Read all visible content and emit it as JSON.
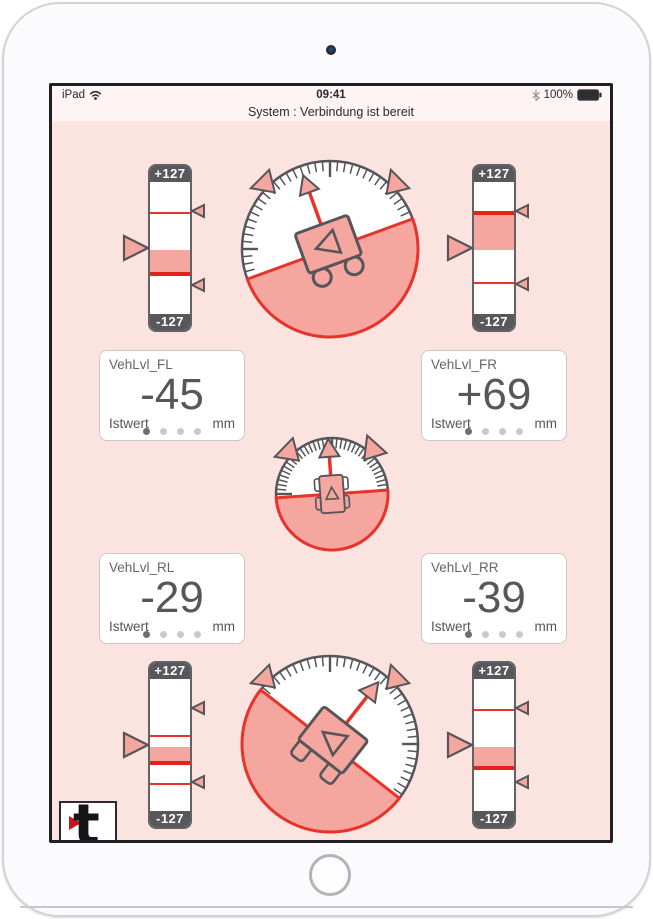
{
  "status_bar": {
    "carrier": "iPad",
    "time": "09:41",
    "battery_pct": "100%"
  },
  "subtitle": "System : Verbindung ist bereit",
  "cards": [
    {
      "title": "VehLvl_FL",
      "value": "-45",
      "caption_left": "Istwert",
      "caption_right": "mm",
      "dots": [
        true,
        false,
        false,
        false
      ]
    },
    {
      "title": "VehLvl_FR",
      "value": "+69",
      "caption_left": "Istwert",
      "caption_right": "mm",
      "dots": [
        true,
        false,
        false,
        false
      ]
    },
    {
      "title": "VehLvl_RL",
      "value": "-29",
      "caption_left": "Istwert",
      "caption_right": "mm",
      "dots": [
        true,
        false,
        false,
        false
      ]
    },
    {
      "title": "VehLvl_RR",
      "value": "-39",
      "caption_left": "Istwert",
      "caption_right": "mm",
      "dots": [
        true,
        false,
        false,
        false
      ]
    }
  ],
  "vgauges": [
    {
      "name": "front-left",
      "top_label": "+127",
      "bottom_label": "-127",
      "range": 127,
      "value": -45,
      "thin_lines": [
        69
      ],
      "markers": [
        69,
        -68
      ]
    },
    {
      "name": "front-right",
      "top_label": "+127",
      "bottom_label": "-127",
      "range": 127,
      "value": 69,
      "thin_lines": [
        -60
      ],
      "markers": [
        69,
        -67
      ]
    },
    {
      "name": "rear-left",
      "top_label": "+127",
      "bottom_label": "-127",
      "range": 127,
      "value": -29,
      "thin_lines": [
        21,
        -69
      ],
      "markers": [
        68,
        -69
      ]
    },
    {
      "name": "rear-right",
      "top_label": "+127",
      "bottom_label": "-127",
      "range": 127,
      "value": -39,
      "thin_lines": [
        68
      ],
      "markers": [
        68,
        -69
      ]
    }
  ],
  "dials": [
    {
      "name": "front-axle-tilt",
      "tilt_deg": -20,
      "vehicle": "rear",
      "peak_marks_deg": [
        -45,
        45
      ]
    },
    {
      "name": "overhead-tilt",
      "tilt_deg": -4,
      "vehicle": "top",
      "peak_marks_deg": [
        -46,
        42
      ]
    },
    {
      "name": "rear-axle-tilt",
      "tilt_deg": 38,
      "vehicle": "side",
      "peak_marks_deg": [
        -45,
        45
      ]
    }
  ],
  "logo": {
    "letter": "t"
  },
  "colors": {
    "accent_red": "#e8322a",
    "value_red": "#e2231a",
    "fill_salmon": "#f5a79f",
    "dial_gray": "#55555a",
    "bg_pink": "#fbe3e0",
    "bg_status": "#fdf4f3",
    "cap_dark": "#58585c"
  }
}
